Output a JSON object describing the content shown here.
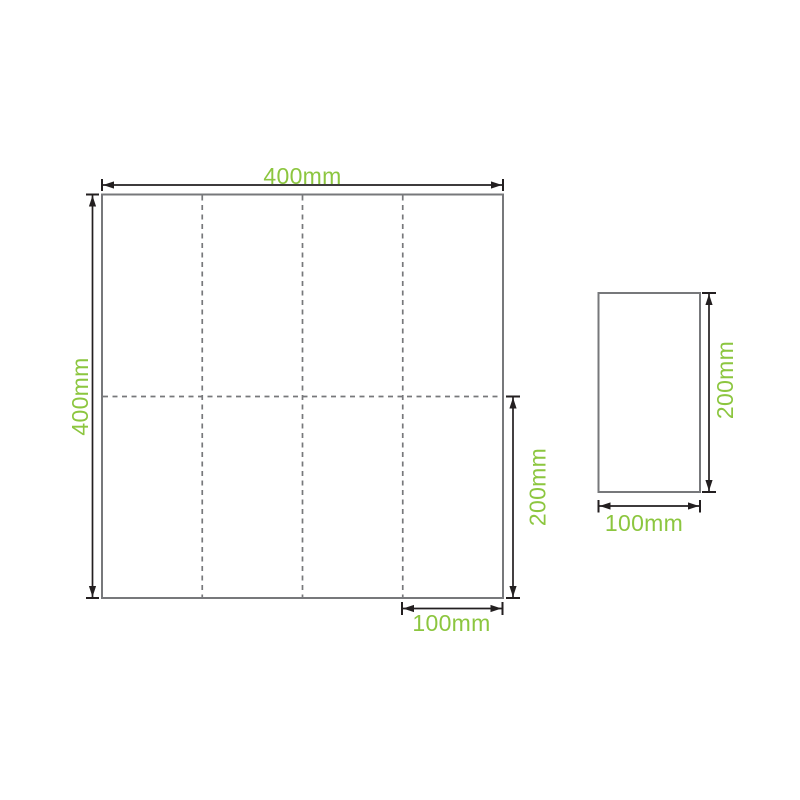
{
  "diagram": {
    "unfolded": {
      "width_label": "400mm",
      "height_label": "400mm",
      "half_height_label": "200mm",
      "panel_width_label": "100mm"
    },
    "folded": {
      "height_label": "200mm",
      "width_label": "100mm"
    },
    "colors": {
      "accent_green": "#8CC63F",
      "outline_gray": "#77787B",
      "dimension_black": "#231F20",
      "background": "#FFFFFF"
    }
  }
}
